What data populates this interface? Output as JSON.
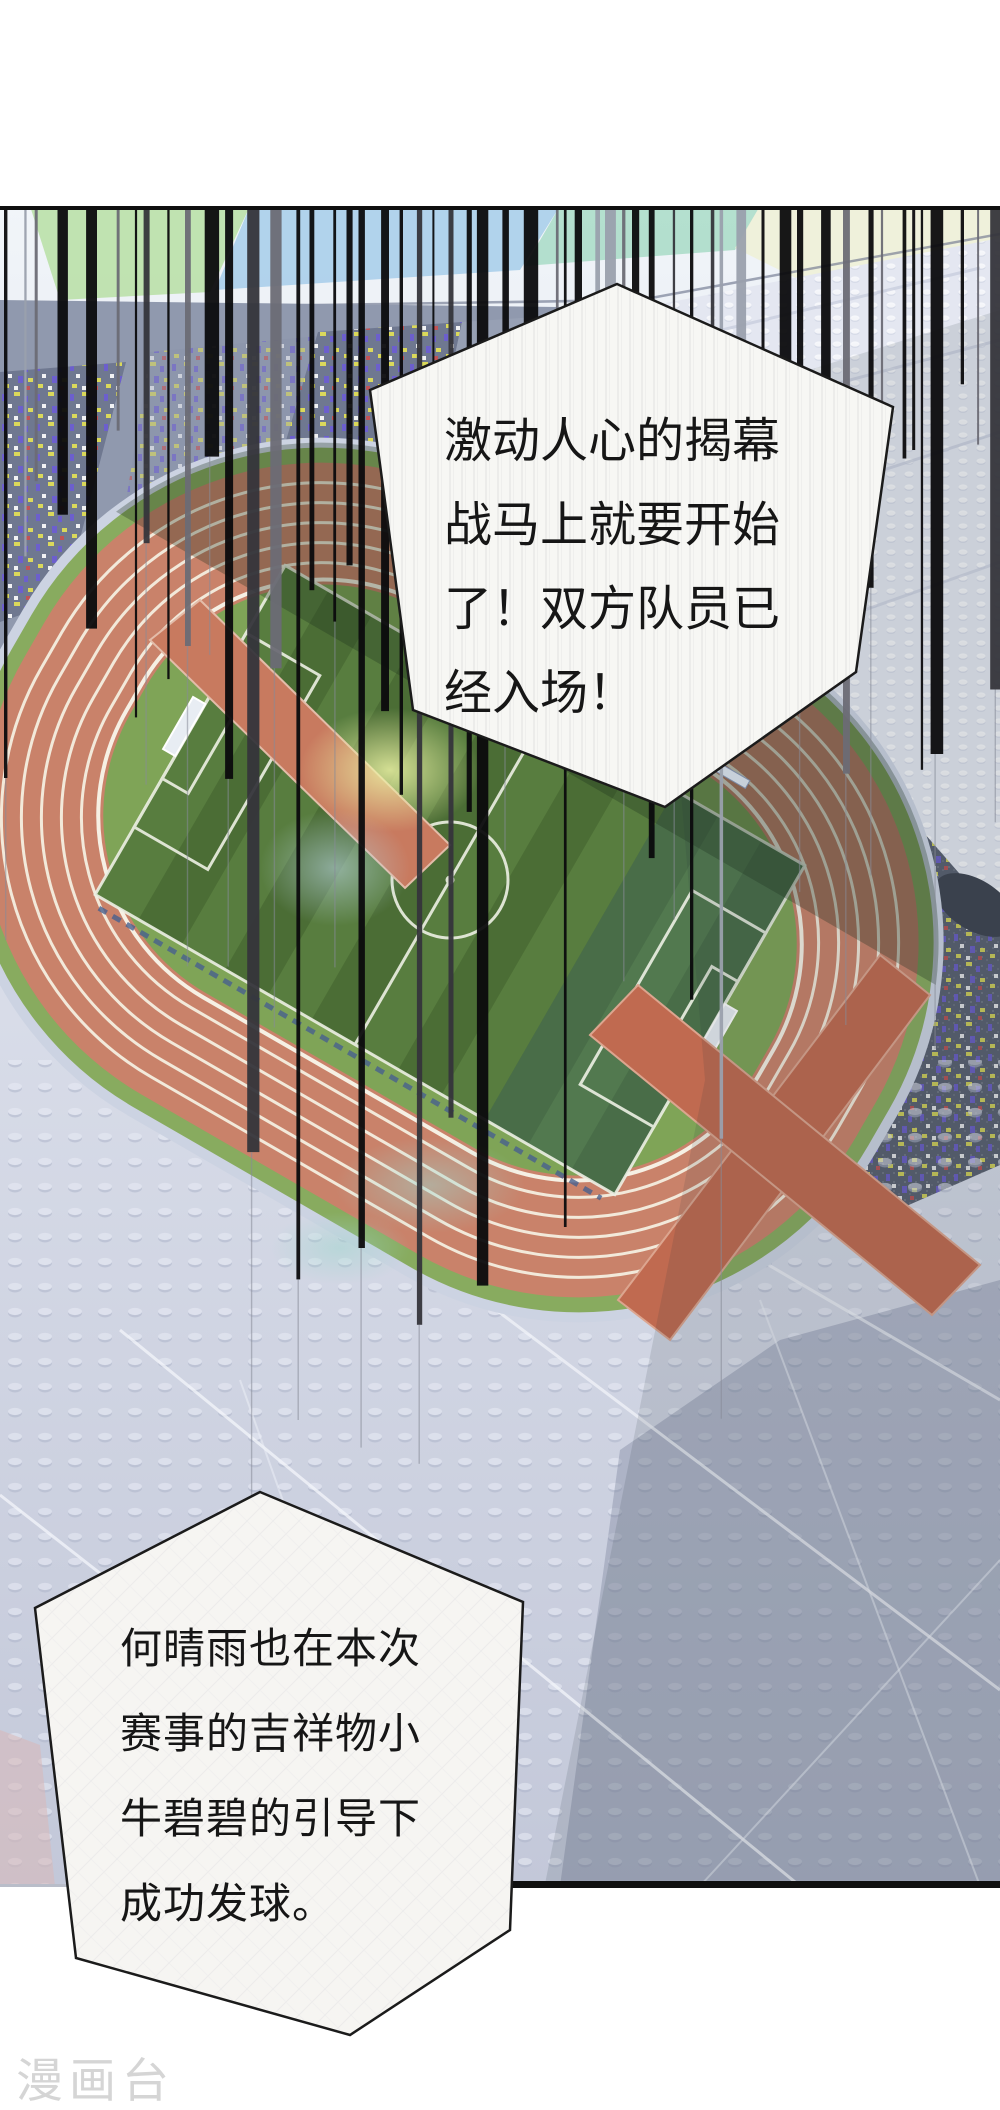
{
  "comic": {
    "bubble_top": {
      "lines": [
        "激动人心的揭幕",
        "战马上就要开始",
        "了！双方队员已",
        "经入场！"
      ]
    },
    "bubble_bottom": {
      "lines": [
        "何晴雨也在本次",
        "赛事的吉祥物小",
        "牛碧碧的引导下",
        "成功发球。"
      ]
    },
    "watermark": "漫画台",
    "colors": {
      "track_salmon": "#c9826a",
      "lane_line": "#f2e9da",
      "apron_green": "#88ab5f",
      "pitch_green": "#4d7036",
      "pitch_stripe": "#567b3d",
      "stands_light": "#e3e6f0",
      "stands_slate": "#8d96ac",
      "stands_dark": "#596070",
      "confetti_purple": "#6c5cd4",
      "confetti_yellow": "#e6e455",
      "speed_line": "#0b0b0d",
      "bubble_fill": "#f7f7f4",
      "bubble_border": "#1b1b1b"
    }
  }
}
